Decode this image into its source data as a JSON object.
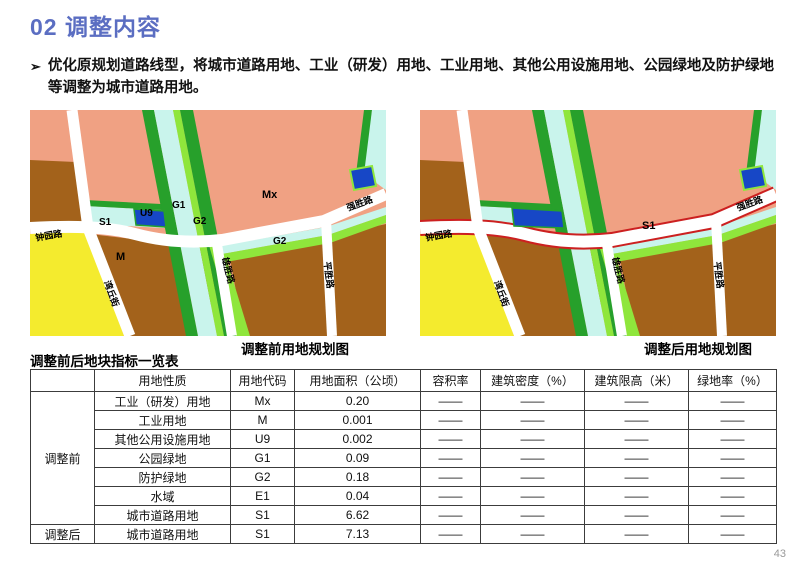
{
  "page": {
    "title": "02 调整内容",
    "title_color": "#5b6ec2",
    "page_number": "43"
  },
  "intro": {
    "marker": "➢",
    "text": "优化原规划道路线型，将城市道路用地、工业（研发）用地、工业用地、其他公用设施用地、公园绿地及防护绿地等调整为城市道路用地。"
  },
  "map_colors": {
    "salmon": "#f0a183",
    "brown": "#a3621b",
    "yellow": "#f4eb2e",
    "dgreen": "#27a02b",
    "lgreen": "#8fe63c",
    "cyan": "#c9f4ec",
    "blue": "#1747c6",
    "road": "#ffffff",
    "red_outline": "#cc2020"
  },
  "maps": {
    "before": {
      "caption": "调整前用地规划图",
      "labels": {
        "mx": "Mx",
        "g1": "G1",
        "u9": "U9",
        "g2a": "G2",
        "s1": "S1",
        "m": "M",
        "g2b": "G2"
      },
      "roads": {
        "zhongyuan": "钟园路",
        "qiangsheng": "强胜路",
        "xiongsheng": "雄胜路",
        "pingsheng": "平胜路",
        "wanqiu": "湾丘街"
      }
    },
    "after": {
      "caption": "调整后用地规划图",
      "labels": {
        "s1": "S1"
      },
      "roads": {
        "zhongyuan": "钟园路",
        "qiangsheng": "强胜路",
        "xiongsheng": "雄胜路",
        "pingsheng": "平胜路",
        "wanqiu": "湾丘街"
      }
    }
  },
  "table": {
    "title": "调整前后地块指标一览表",
    "corner": "",
    "headers": [
      "用地性质",
      "用地代码",
      "用地面积（公顷）",
      "容积率",
      "建筑密度（%）",
      "建筑限高（米）",
      "绿地率（%）"
    ],
    "dash": "——",
    "groups": [
      {
        "name": "调整前",
        "rows": [
          [
            "工业（研发）用地",
            "Mx",
            "0.20"
          ],
          [
            "工业用地",
            "M",
            "0.001"
          ],
          [
            "其他公用设施用地",
            "U9",
            "0.002"
          ],
          [
            "公园绿地",
            "G1",
            "0.09"
          ],
          [
            "防护绿地",
            "G2",
            "0.18"
          ],
          [
            "水域",
            "E1",
            "0.04"
          ],
          [
            "城市道路用地",
            "S1",
            "6.62"
          ]
        ]
      },
      {
        "name": "调整后",
        "rows": [
          [
            "城市道路用地",
            "S1",
            "7.13"
          ]
        ]
      }
    ]
  }
}
